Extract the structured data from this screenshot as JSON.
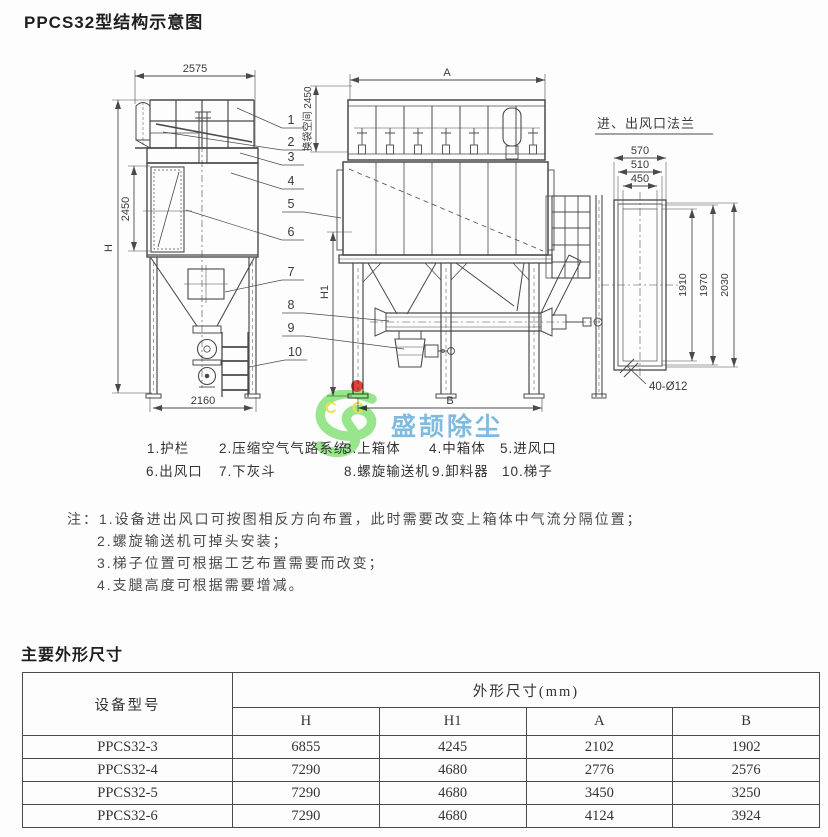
{
  "page": {
    "title": "PPCS32型结构示意图"
  },
  "diagram": {
    "flange_view_title": "进、出风口法兰",
    "dims": {
      "top_width": "2575",
      "total_height": "H",
      "mid_box_height": "2450",
      "base_width": "2160",
      "front_width": "A",
      "bag_space": "换袋空间 2450",
      "leg_height": "H1",
      "base_front_width": "B",
      "flange_w1": "570",
      "flange_w2": "510",
      "flange_w3": "450",
      "flange_h1": "1910",
      "flange_h2": "1970",
      "flange_h3": "2030",
      "flange_holes": "40-Ø12"
    },
    "part_numbers": [
      "1",
      "2",
      "3",
      "4",
      "5",
      "6",
      "7",
      "8",
      "9",
      "10"
    ]
  },
  "watermark": {
    "c1": "C",
    "c2": "C",
    "text": "盛颉除尘"
  },
  "legend": {
    "row1": [
      "1.护栏",
      "2.压缩空气气路系统",
      "3.上箱体",
      "4.中箱体",
      "5.进风口"
    ],
    "row2": [
      "6.出风口",
      "7.下灰斗",
      "8.螺旋输送机",
      "9.卸料器",
      "10.梯子"
    ]
  },
  "notes": {
    "prefix": "注：",
    "items": [
      "1.设备进出风口可按图相反方向布置，此时需要改变上箱体中气流分隔位置；",
      "2.螺旋输送机可掉头安装；",
      "3.梯子位置可根据工艺布置需要而改变；",
      "4.支腿高度可根据需要增减。"
    ]
  },
  "spec_table": {
    "section_title": "主要外形尺寸",
    "model_header": "设备型号",
    "group_header": "外形尺寸(mm)",
    "columns": [
      "H",
      "H1",
      "A",
      "B"
    ],
    "rows": [
      {
        "model": "PPCS32-3",
        "H": "6855",
        "H1": "4245",
        "A": "2102",
        "B": "1902"
      },
      {
        "model": "PPCS32-4",
        "H": "7290",
        "H1": "4680",
        "A": "2776",
        "B": "2576"
      },
      {
        "model": "PPCS32-5",
        "H": "7290",
        "H1": "4680",
        "A": "3450",
        "B": "3250"
      },
      {
        "model": "PPCS32-6",
        "H": "7290",
        "H1": "4680",
        "A": "4124",
        "B": "3924"
      }
    ]
  }
}
